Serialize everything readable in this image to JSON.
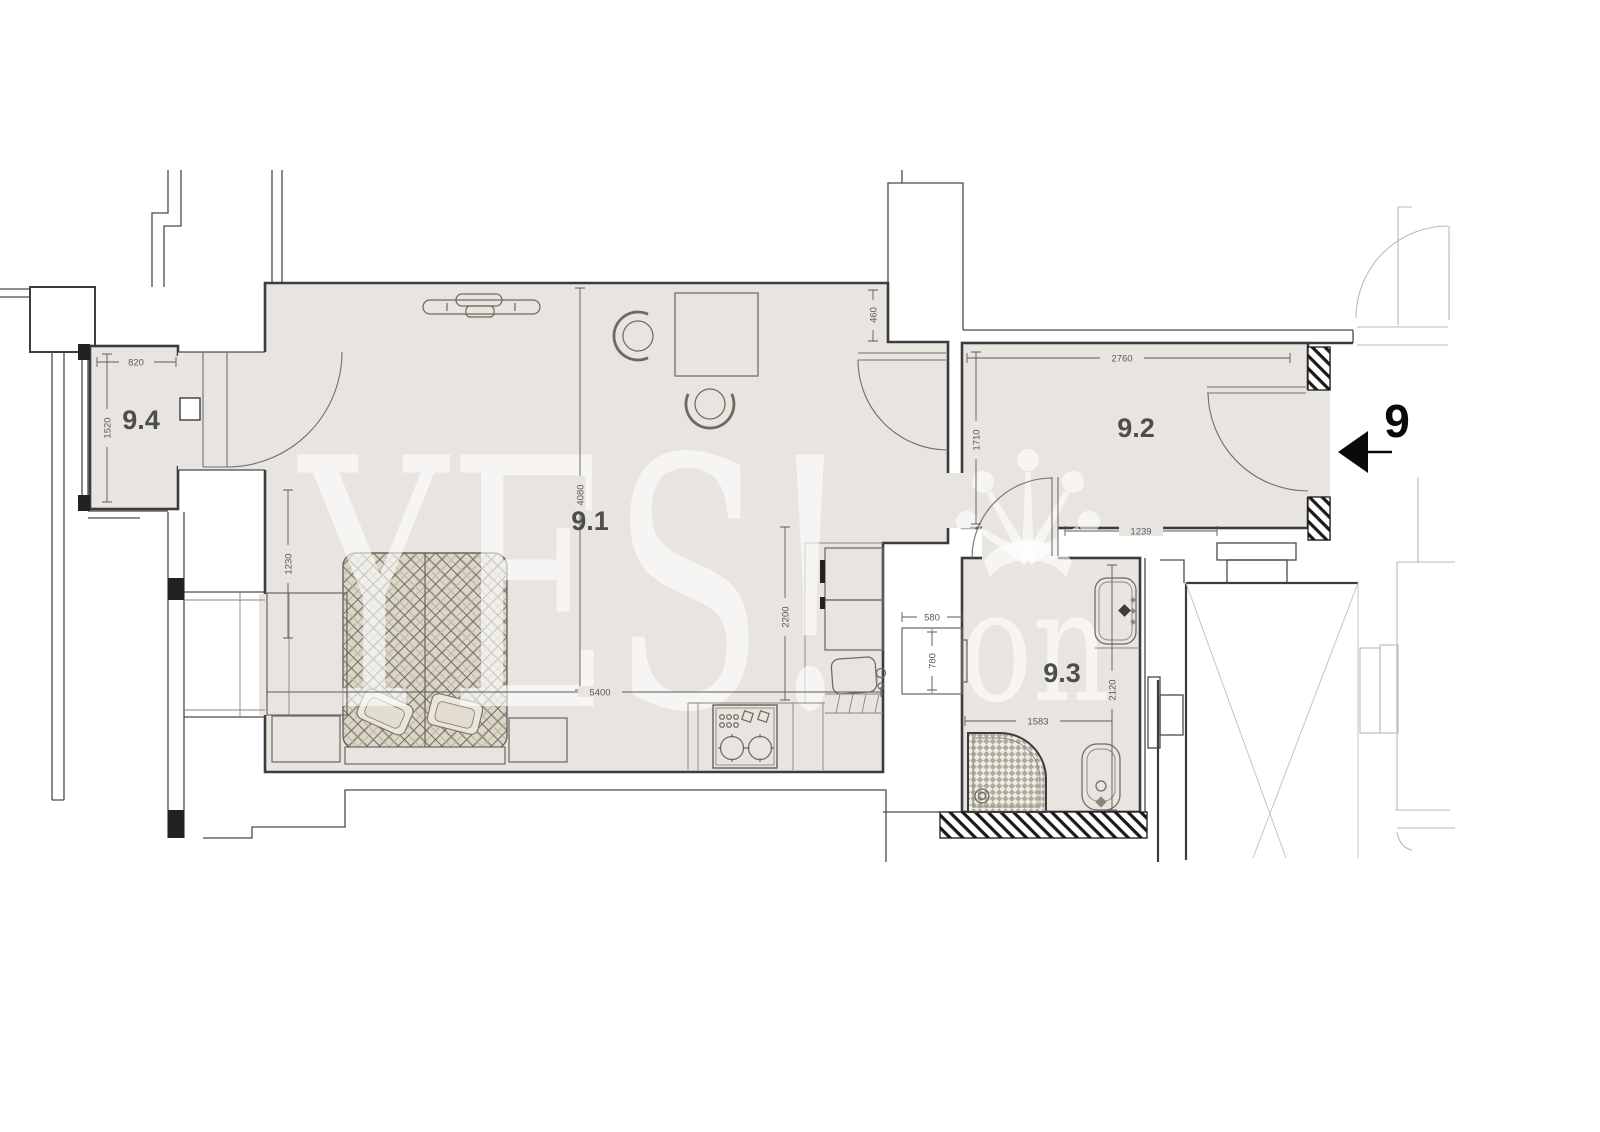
{
  "unit": {
    "number": "9"
  },
  "rooms": [
    {
      "id": "9.1",
      "label": "9.1"
    },
    {
      "id": "9.2",
      "label": "9.2"
    },
    {
      "id": "9.3",
      "label": "9.3"
    },
    {
      "id": "9.4",
      "label": "9.4"
    }
  ],
  "dimensions_mm": {
    "room94_width": "820",
    "room94_depth": "1520",
    "bed_wall_offset": "1230",
    "room91_depth": "4080",
    "room91_width": "5400",
    "kitchen_recess_depth": "2200",
    "pier_length": "460",
    "room92_width": "2760",
    "room92_depth": "1710",
    "room92_opening": "1239",
    "washer_width": "580",
    "washer_depth": "780",
    "room93_width": "1583",
    "room93_depth": "2120"
  },
  "watermark": {
    "text": "YES!",
    "subtext": "on"
  },
  "colors": {
    "room_fill": "#e8e5e0",
    "wall_dark": "#3c3c3c",
    "dimension_gray": "#5a5a5a",
    "furniture_gray": "#6e6a60",
    "neighbor_light": "#bdb9b0",
    "watermark_white": "rgba(255,255,255,0.6)",
    "accent_black": "#0a0a0a"
  }
}
